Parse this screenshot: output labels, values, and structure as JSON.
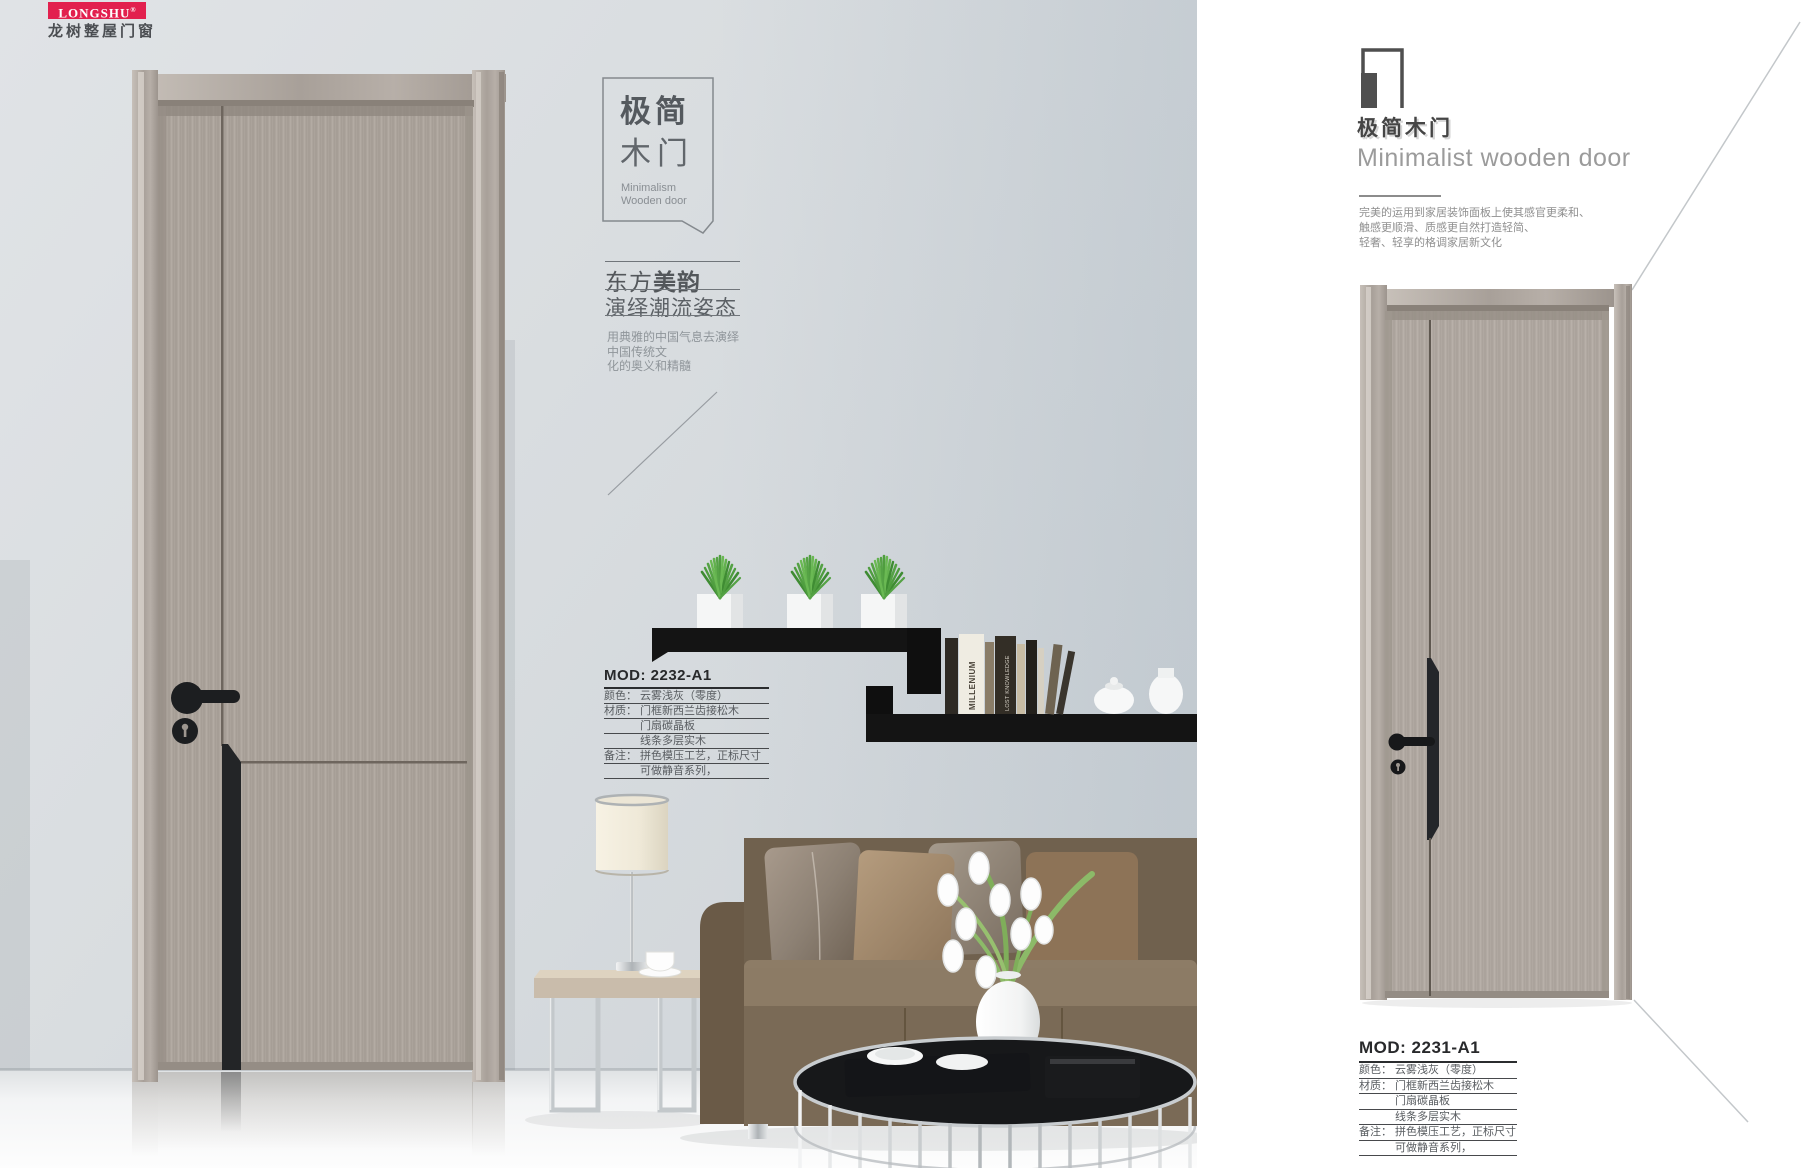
{
  "brand": {
    "logo_text": "LONGSHU",
    "registered": "®",
    "logo_sub": "龙树整屋门窗",
    "brand_red": "#e2204e"
  },
  "left": {
    "label_box": {
      "cn_line1": "极简",
      "cn_line2": "木门",
      "en_line1": "Minimalism",
      "en_line2": "Wooden door"
    },
    "tagline": {
      "part1": "东方",
      "part2": "美韵",
      "line2": "演绎潮流姿态"
    },
    "paragraph": {
      "l1": "用典雅的中国气息去演绎",
      "l2": "中国传统文",
      "l3": "化的奥义和精髓"
    },
    "spec": {
      "model": "MOD: 2232-A1",
      "rows": [
        {
          "label": "颜色：",
          "text": "云雾浅灰（零度）"
        },
        {
          "label": "材质：",
          "text": "门框新西兰齿接松木"
        },
        {
          "label": "",
          "text": "门扇碳晶板"
        },
        {
          "label": "",
          "text": "线条多层实木"
        },
        {
          "label": "备注：",
          "text": "拼色模压工艺，正标尺寸"
        },
        {
          "label": "",
          "text": "可做静音系列，"
        }
      ]
    },
    "books": [
      "MILLENIUM",
      "LOST KNOWLEDGE"
    ]
  },
  "right": {
    "index_number": "1",
    "title_cn": "极简木门",
    "title_en": "Minimalist wooden door",
    "paragraph": {
      "l1": "完美的运用到家居装饰面板上使其感官更柔和、",
      "l2": "触感更顺滑、质感更自然打造轻简、",
      "l3": "轻奢、轻享的格调家居新文化"
    },
    "spec": {
      "model": "MOD: 2231-A1",
      "rows": [
        {
          "label": "颜色：",
          "text": "云雾浅灰（零度）"
        },
        {
          "label": "材质：",
          "text": "门框新西兰齿接松木"
        },
        {
          "label": "",
          "text": "门扇碳晶板"
        },
        {
          "label": "",
          "text": "线条多层实木"
        },
        {
          "label": "备注：",
          "text": "拼色模压工艺，正标尺寸"
        },
        {
          "label": "",
          "text": "可做静音系列，"
        }
      ]
    }
  },
  "colors": {
    "shelf_black": "#141414",
    "door_gray": "#a9a199",
    "accent_dark": "#4f4f4f"
  }
}
